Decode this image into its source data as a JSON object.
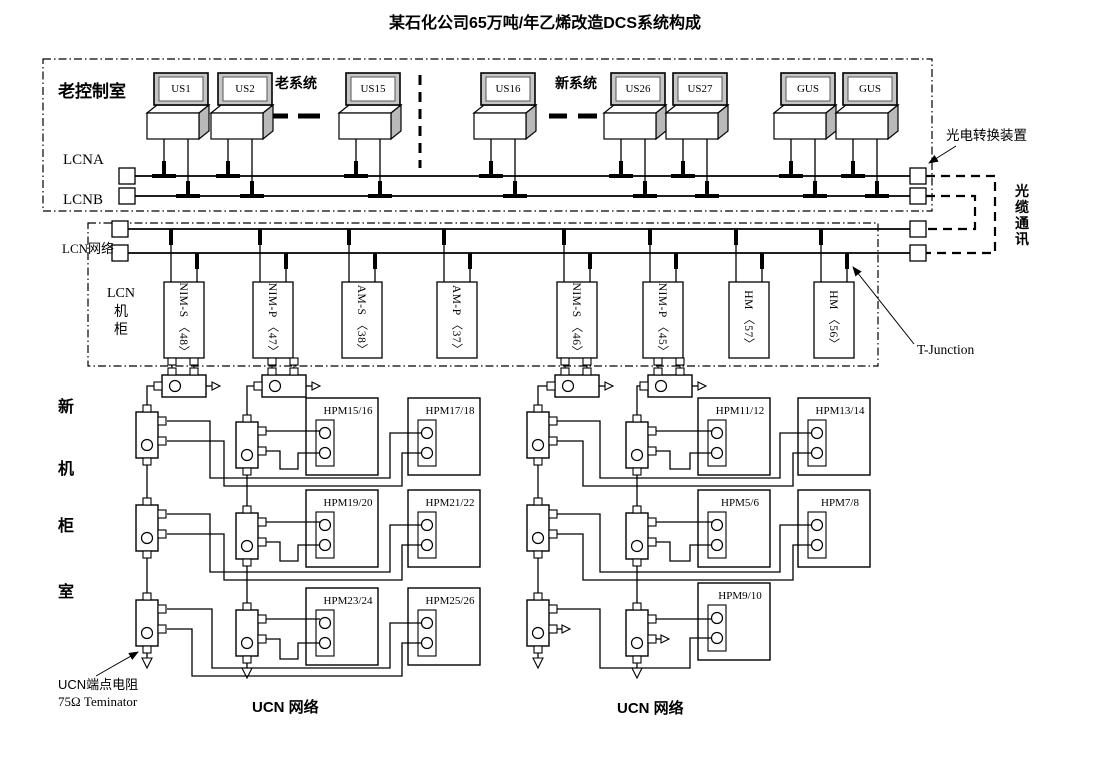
{
  "title": "某石化公司65万吨/年乙烯改造DCS系统构成",
  "old_room": {
    "label": "老控制室",
    "old_system": "老系统",
    "new_system": "新系统",
    "lcna": "LCNA",
    "lcnb": "LCNB",
    "computers": [
      "US1",
      "US2",
      "US15",
      "US16",
      "US26",
      "US27",
      "GUS",
      "GUS"
    ]
  },
  "lcn": {
    "network": "LCN网络",
    "cabinet": [
      "LCN",
      "机",
      "柜"
    ],
    "modules": [
      "NIM-S 〈48〉",
      "NIM-P 〈47〉",
      "AM-S 〈38〉",
      "AM-P 〈37〉",
      "NIM-S 〈46〉",
      "NIM-P 〈45〉",
      "HM 〈57〉",
      "HM 〈56〉"
    ]
  },
  "hpm_left": [
    "HPM15/16",
    "HPM17/18",
    "HPM19/20",
    "HPM21/22",
    "HPM23/24",
    "HPM25/26"
  ],
  "hpm_right": [
    "HPM11/12",
    "HPM13/14",
    "HPM5/6",
    "HPM7/8",
    "HPM9/10"
  ],
  "annotations": {
    "converter": "光电转换装置",
    "fiber": [
      "光",
      "缆",
      "通",
      "讯"
    ],
    "t_junction": "T-Junction",
    "ucn_terminator_cn": "UCN端点电阻",
    "ucn_terminator_en": "75Ω Teminator",
    "ucn_left": "UCN 网络",
    "ucn_right": "UCN 网络",
    "room": [
      "新",
      "机",
      "柜",
      "室"
    ]
  }
}
